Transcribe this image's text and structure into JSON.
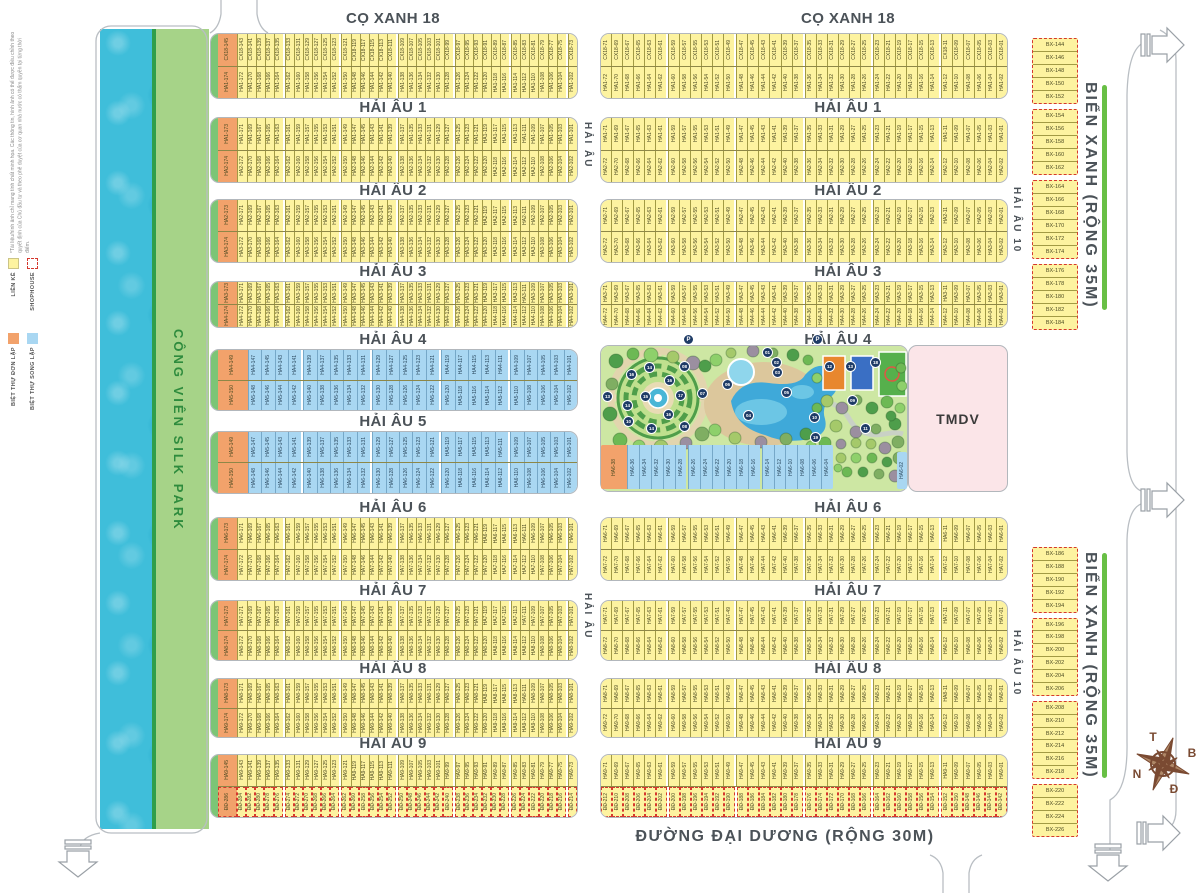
{
  "disclaimer": "*Tài liệu/hình ảnh chỉ mang tính chất minh họa. Các thông tin, hình ảnh có thể được điều chỉnh theo quyết định của Chủ đầu tư và theo phê duyệt của cơ quan nhà nước có thẩm quyền tại từng thời điểm.",
  "legend": {
    "items": [
      {
        "label": "LIỀN KỀ",
        "swatch": "yellow"
      },
      {
        "label": "SHOPHOUSE",
        "swatch": "dashed"
      },
      {
        "label": "BIỆT THỰ ĐƠN LẬP",
        "swatch": "orange"
      },
      {
        "label": "BIỆT THỰ SONG LẬP",
        "swatch": "blue"
      }
    ]
  },
  "colors": {
    "yellow_lot": "#fdf3a0",
    "orange_lot": "#f2a26b",
    "blue_lot": "#a9d7f2",
    "shophouse_dash": "#d5382e",
    "water": "#3fbeda",
    "park_strip": "#a6d388",
    "park_bg": "#cde7a3",
    "tmdv": "#fbe5e8",
    "street_text": "#4b5258",
    "green_median": "#68bf45",
    "compass": "#7a4a32"
  },
  "park_strip_label": "CÔNG VIÊN SILK PARK",
  "tmdv": {
    "label": "TMDV"
  },
  "bottom_street": "ĐƯỜNG ĐẠI DƯƠNG (RỘNG 30M)",
  "compass": {
    "top": "T",
    "right": "B",
    "left": "N",
    "bottom": "Đ"
  },
  "street_labels": [
    {
      "text": "CỌ XANH 18",
      "x": 393,
      "y": 10
    },
    {
      "text": "CỌ XANH 18",
      "x": 848,
      "y": 10
    },
    {
      "text": "HẢI ÂU 1",
      "x": 393,
      "y": 99
    },
    {
      "text": "HẢI ÂU 1",
      "x": 848,
      "y": 99
    },
    {
      "text": "HẢI ÂU 2",
      "x": 393,
      "y": 182
    },
    {
      "text": "HẢI ÂU 2",
      "x": 848,
      "y": 182
    },
    {
      "text": "HẢI ÂU 3",
      "x": 393,
      "y": 263
    },
    {
      "text": "HẢI ÂU 3",
      "x": 848,
      "y": 263
    },
    {
      "text": "HẢI ÂU 4",
      "x": 393,
      "y": 331
    },
    {
      "text": "HẢI ÂU 4",
      "x": 838,
      "y": 331
    },
    {
      "text": "HẢI ÂU 5",
      "x": 393,
      "y": 413
    },
    {
      "text": "HẢI ÂU 6",
      "x": 393,
      "y": 499
    },
    {
      "text": "HẢI ÂU 6",
      "x": 848,
      "y": 499
    },
    {
      "text": "HẢI ÂU 7",
      "x": 393,
      "y": 582
    },
    {
      "text": "HẢI ÂU 7",
      "x": 848,
      "y": 582
    },
    {
      "text": "HẢI ÂU 8",
      "x": 393,
      "y": 660
    },
    {
      "text": "HẢI ÂU 8",
      "x": 848,
      "y": 660
    },
    {
      "text": "HẢI ÂU 9",
      "x": 393,
      "y": 735
    },
    {
      "text": "HẢI ÂU 9",
      "x": 848,
      "y": 735
    }
  ],
  "vertical_labels": [
    {
      "text": "HẢI ÂU",
      "x": 582,
      "y": 112,
      "h": 66,
      "size": 10
    },
    {
      "text": "HẢI ÂU",
      "x": 582,
      "y": 583,
      "h": 66,
      "size": 10
    },
    {
      "text": "HẢI ÂU 10",
      "x": 1011,
      "y": 172,
      "h": 96,
      "size": 10
    },
    {
      "text": "HẢI ÂU 10",
      "x": 1011,
      "y": 615,
      "h": 96,
      "size": 10
    },
    {
      "text": "BIỂN XANH (RỘNG 35M)",
      "x": 1081,
      "y": 68,
      "h": 255,
      "size": 16
    },
    {
      "text": "BIỂN XANH (RỘNG 35M)",
      "x": 1081,
      "y": 538,
      "h": 255,
      "size": 16
    },
    {
      "text": "CÔNG VIÊN SILK PARK",
      "x": 171,
      "y": 308,
      "h": 245,
      "size": 13,
      "cls": "park-label"
    }
  ],
  "green_lines": [
    {
      "x": 1102,
      "y": 85,
      "h": 225
    },
    {
      "x": 1102,
      "y": 553,
      "h": 225
    }
  ],
  "blocks": [
    {
      "id": "cx18-left",
      "x": 210,
      "y": 33,
      "w": 366,
      "h": 64,
      "green": true,
      "rows": [
        {
          "prefix": "CX18-",
          "start": 145,
          "step": -2,
          "count": 37,
          "type": "yellow",
          "orange_first": true,
          "gap": 6
        },
        {
          "prefix": "HA1-",
          "start": 174,
          "step": -2,
          "count": 37,
          "type": "yellow",
          "orange_first": true,
          "gap": 6
        }
      ]
    },
    {
      "id": "cx18-right",
      "x": 600,
      "y": 33,
      "w": 406,
      "h": 64,
      "rows": [
        {
          "prefix": "CX18-",
          "start": 71,
          "step": -2,
          "count": 36,
          "type": "yellow",
          "gap": 6
        },
        {
          "prefix": "HA1-",
          "start": 72,
          "step": -2,
          "count": 36,
          "type": "yellow",
          "gap": 6
        }
      ]
    },
    {
      "id": "ha1-left",
      "x": 210,
      "y": 117,
      "w": 366,
      "h": 64,
      "green": true,
      "rows": [
        {
          "prefix": "HA1-",
          "start": 173,
          "step": -2,
          "count": 37,
          "type": "yellow",
          "orange_first": true,
          "gap": 6
        },
        {
          "prefix": "HA2-",
          "start": 174,
          "step": -2,
          "count": 37,
          "type": "yellow",
          "orange_first": true,
          "gap": 6
        }
      ]
    },
    {
      "id": "ha1-right",
      "x": 600,
      "y": 117,
      "w": 406,
      "h": 64,
      "rows": [
        {
          "prefix": "HA1-",
          "start": 71,
          "step": -2,
          "count": 36,
          "type": "yellow",
          "gap": 6
        },
        {
          "prefix": "HA2-",
          "start": 72,
          "step": -2,
          "count": 36,
          "type": "yellow",
          "gap": 6
        }
      ]
    },
    {
      "id": "ha2-left",
      "x": 210,
      "y": 199,
      "w": 366,
      "h": 62,
      "green": true,
      "rows": [
        {
          "prefix": "HA2-",
          "start": 173,
          "step": -2,
          "count": 37,
          "type": "yellow",
          "orange_first": true,
          "gap": 6
        },
        {
          "prefix": "HA3-",
          "start": 174,
          "step": -2,
          "count": 37,
          "type": "yellow",
          "orange_first": true,
          "gap": 6
        }
      ]
    },
    {
      "id": "ha2-right",
      "x": 600,
      "y": 199,
      "w": 406,
      "h": 62,
      "rows": [
        {
          "prefix": "HA2-",
          "start": 71,
          "step": -2,
          "count": 36,
          "type": "yellow",
          "gap": 6
        },
        {
          "prefix": "HA3-",
          "start": 72,
          "step": -2,
          "count": 36,
          "type": "yellow",
          "gap": 6
        }
      ]
    },
    {
      "id": "ha3-left",
      "x": 210,
      "y": 281,
      "w": 366,
      "h": 45,
      "green": true,
      "rows": [
        {
          "prefix": "HA3-",
          "start": 173,
          "step": -2,
          "count": 37,
          "type": "yellow",
          "orange_first": true,
          "gap": 6
        },
        {
          "prefix": "HA4-",
          "start": 174,
          "step": -2,
          "count": 37,
          "type": "yellow",
          "orange_first": true,
          "gap": 6
        }
      ]
    },
    {
      "id": "ha3-right",
      "x": 600,
      "y": 281,
      "w": 406,
      "h": 45,
      "rows": [
        {
          "prefix": "HA3-",
          "start": 71,
          "step": -2,
          "count": 36,
          "type": "yellow",
          "gap": 6
        },
        {
          "prefix": "HA4-",
          "start": 72,
          "step": -2,
          "count": 36,
          "type": "yellow",
          "gap": 6
        }
      ]
    },
    {
      "id": "ha4-left",
      "x": 210,
      "y": 349,
      "w": 366,
      "h": 60,
      "green": true,
      "rows": [
        {
          "prefix": "HA4-",
          "start": 149,
          "step": -2,
          "count": 25,
          "type": "blue",
          "orange_first": true,
          "gap": 5
        },
        {
          "prefix": "HA5-",
          "start": 150,
          "step": -2,
          "count": 25,
          "type": "blue",
          "orange_first": true,
          "gap": 5
        }
      ]
    },
    {
      "id": "ha5-left",
      "x": 210,
      "y": 431,
      "w": 366,
      "h": 61,
      "green": true,
      "rows": [
        {
          "prefix": "HA5-",
          "start": 149,
          "step": -2,
          "count": 25,
          "type": "blue",
          "orange_first": true,
          "gap": 5
        },
        {
          "prefix": "HA6-",
          "start": 150,
          "step": -2,
          "count": 25,
          "type": "blue",
          "orange_first": true,
          "gap": 5
        }
      ]
    },
    {
      "id": "park-row",
      "x": 601,
      "y": 445,
      "w": 232,
      "h": 44,
      "noborder": true,
      "rows": [
        {
          "prefix": "HA6-",
          "start": 38,
          "step": -2,
          "count": 18,
          "type": "blue",
          "orange_first": true,
          "gap": 6
        }
      ]
    },
    {
      "id": "tmdv-lot",
      "x": 897,
      "y": 452,
      "w": 10,
      "h": 37,
      "noborder": true,
      "rows": [
        {
          "prefix": "HA6-",
          "start": 2,
          "step": -2,
          "count": 1,
          "type": "blue",
          "gap": 9
        }
      ]
    },
    {
      "id": "ha6-left",
      "x": 210,
      "y": 517,
      "w": 366,
      "h": 62,
      "green": true,
      "rows": [
        {
          "prefix": "HA6-",
          "start": 173,
          "step": -2,
          "count": 37,
          "type": "yellow",
          "orange_first": true,
          "gap": 6
        },
        {
          "prefix": "HA7-",
          "start": 174,
          "step": -2,
          "count": 37,
          "type": "yellow",
          "orange_first": true,
          "gap": 6
        }
      ]
    },
    {
      "id": "ha6-right",
      "x": 600,
      "y": 517,
      "w": 406,
      "h": 62,
      "rows": [
        {
          "prefix": "HA6-",
          "start": 71,
          "step": -2,
          "count": 36,
          "type": "yellow",
          "gap": 6
        },
        {
          "prefix": "HA7-",
          "start": 72,
          "step": -2,
          "count": 36,
          "type": "yellow",
          "gap": 6
        }
      ]
    },
    {
      "id": "ha7-left",
      "x": 210,
      "y": 600,
      "w": 366,
      "h": 59,
      "green": true,
      "rows": [
        {
          "prefix": "HA7-",
          "start": 173,
          "step": -2,
          "count": 37,
          "type": "yellow",
          "orange_first": true,
          "gap": 6
        },
        {
          "prefix": "HA8-",
          "start": 174,
          "step": -2,
          "count": 37,
          "type": "yellow",
          "orange_first": true,
          "gap": 6
        }
      ]
    },
    {
      "id": "ha7-right",
      "x": 600,
      "y": 600,
      "w": 406,
      "h": 59,
      "rows": [
        {
          "prefix": "HA7-",
          "start": 71,
          "step": -2,
          "count": 36,
          "type": "yellow",
          "gap": 6
        },
        {
          "prefix": "HA8-",
          "start": 72,
          "step": -2,
          "count": 36,
          "type": "yellow",
          "gap": 6
        }
      ]
    },
    {
      "id": "ha8-left",
      "x": 210,
      "y": 678,
      "w": 366,
      "h": 58,
      "green": true,
      "rows": [
        {
          "prefix": "HA8-",
          "start": 173,
          "step": -2,
          "count": 37,
          "type": "yellow",
          "orange_first": true,
          "gap": 6
        },
        {
          "prefix": "HA9-",
          "start": 174,
          "step": -2,
          "count": 37,
          "type": "yellow",
          "orange_first": true,
          "gap": 6
        }
      ]
    },
    {
      "id": "ha8-right",
      "x": 600,
      "y": 678,
      "w": 406,
      "h": 58,
      "rows": [
        {
          "prefix": "HA8-",
          "start": 71,
          "step": -2,
          "count": 36,
          "type": "yellow",
          "gap": 6
        },
        {
          "prefix": "HA9-",
          "start": 72,
          "step": -2,
          "count": 36,
          "type": "yellow",
          "gap": 6
        }
      ]
    },
    {
      "id": "ha9-left",
      "x": 210,
      "y": 754,
      "w": 366,
      "h": 62,
      "green": true,
      "rows": [
        {
          "prefix": "HA9-",
          "start": 145,
          "step": -2,
          "count": 37,
          "type": "yellow",
          "orange_first": true,
          "gap": 6
        },
        {
          "prefix": "ĐĐ-",
          "start": 286,
          "step": -2,
          "count": 37,
          "type": "yellow",
          "orange_first": true,
          "dashed": true,
          "gap": 6
        }
      ]
    },
    {
      "id": "ha9-right",
      "x": 600,
      "y": 754,
      "w": 406,
      "h": 62,
      "rows": [
        {
          "prefix": "HA9-",
          "start": 71,
          "step": -2,
          "count": 36,
          "type": "yellow",
          "gap": 6
        },
        {
          "prefix": "ĐĐ-",
          "start": 212,
          "step": -2,
          "count": 36,
          "type": "yellow",
          "dashed": true,
          "gap": 6
        }
      ]
    }
  ],
  "bx_columns": [
    {
      "x": 1032,
      "y": 38,
      "w": 46,
      "h": 292,
      "prefix": "BX-",
      "groups": [
        [
          144,
          152
        ],
        [
          154,
          162
        ],
        [
          164,
          174
        ],
        [
          176,
          184
        ]
      ]
    },
    {
      "x": 1032,
      "y": 547,
      "w": 46,
      "h": 290,
      "prefix": "BX-",
      "groups": [
        [
          186,
          194
        ],
        [
          196,
          206
        ],
        [
          208,
          218
        ],
        [
          220,
          226
        ]
      ]
    }
  ],
  "park": {
    "markers": [
      {
        "t": "P",
        "x": 688,
        "y": 339
      },
      {
        "t": "P",
        "x": 817,
        "y": 339
      },
      {
        "t": "01",
        "x": 767,
        "y": 352
      },
      {
        "t": "02",
        "x": 776,
        "y": 362
      },
      {
        "t": "03",
        "x": 777,
        "y": 372
      },
      {
        "t": "04",
        "x": 748,
        "y": 415
      },
      {
        "t": "05",
        "x": 786,
        "y": 392
      },
      {
        "t": "06",
        "x": 727,
        "y": 384
      },
      {
        "t": "07",
        "x": 702,
        "y": 393
      },
      {
        "t": "08",
        "x": 684,
        "y": 366
      },
      {
        "t": "08",
        "x": 684,
        "y": 426
      },
      {
        "t": "09",
        "x": 852,
        "y": 400
      },
      {
        "t": "10",
        "x": 628,
        "y": 421
      },
      {
        "t": "10",
        "x": 814,
        "y": 417
      },
      {
        "t": "11",
        "x": 865,
        "y": 428
      },
      {
        "t": "12",
        "x": 829,
        "y": 366
      },
      {
        "t": "13",
        "x": 607,
        "y": 396
      },
      {
        "t": "13",
        "x": 850,
        "y": 366
      },
      {
        "t": "14",
        "x": 649,
        "y": 367
      },
      {
        "t": "14",
        "x": 627,
        "y": 405
      },
      {
        "t": "14",
        "x": 651,
        "y": 428
      },
      {
        "t": "15",
        "x": 645,
        "y": 396
      },
      {
        "t": "16",
        "x": 631,
        "y": 374
      },
      {
        "t": "16",
        "x": 669,
        "y": 380
      },
      {
        "t": "16",
        "x": 668,
        "y": 414
      },
      {
        "t": "17",
        "x": 680,
        "y": 395
      },
      {
        "t": "18",
        "x": 875,
        "y": 362
      },
      {
        "t": "19",
        "x": 815,
        "y": 437
      }
    ]
  }
}
